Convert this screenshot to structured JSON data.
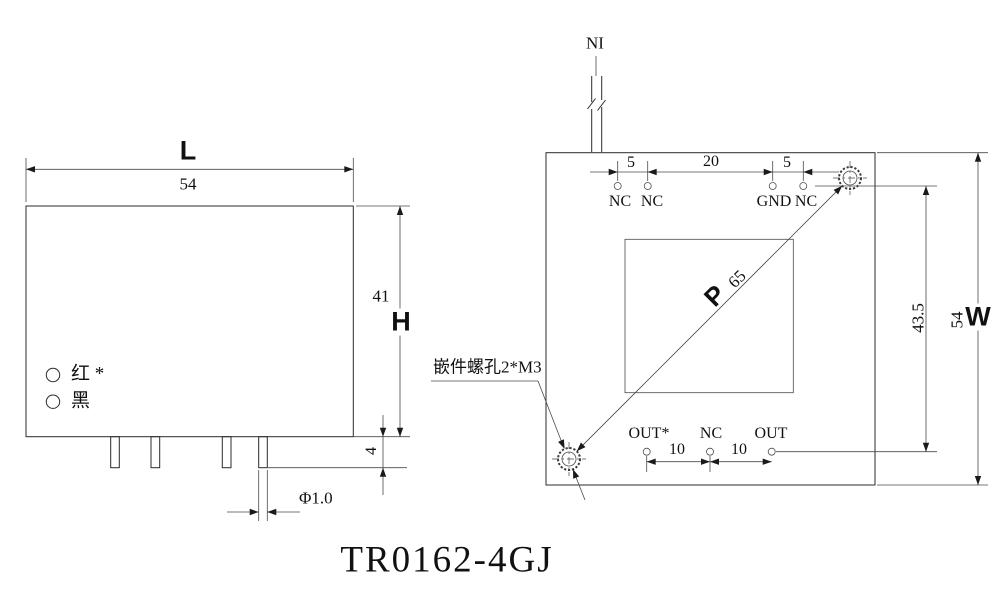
{
  "ink_color": "#1a1a1a",
  "title": "TR0162-4GJ",
  "left_view": {
    "length_letter": "L",
    "length_value": "54",
    "height_value": "41",
    "height_letter": "H",
    "pin_length": "4",
    "pin_diameter": "Φ1.0",
    "red_wire": "红 *",
    "black_wire": "黑"
  },
  "right_view": {
    "input_label": "NI",
    "top_dims": [
      "5",
      "20",
      "5"
    ],
    "top_pins": [
      "NC",
      "NC",
      "GND",
      "NC"
    ],
    "insert_note": "嵌件螺孔2*M3",
    "pitch_letter": "P",
    "pitch_value": "65",
    "bottom_pins": [
      "OUT*",
      "NC",
      "OUT"
    ],
    "bottom_dims": [
      "10",
      "10"
    ],
    "hole_span": "43.5",
    "width_value": "54",
    "width_letter": "W"
  }
}
